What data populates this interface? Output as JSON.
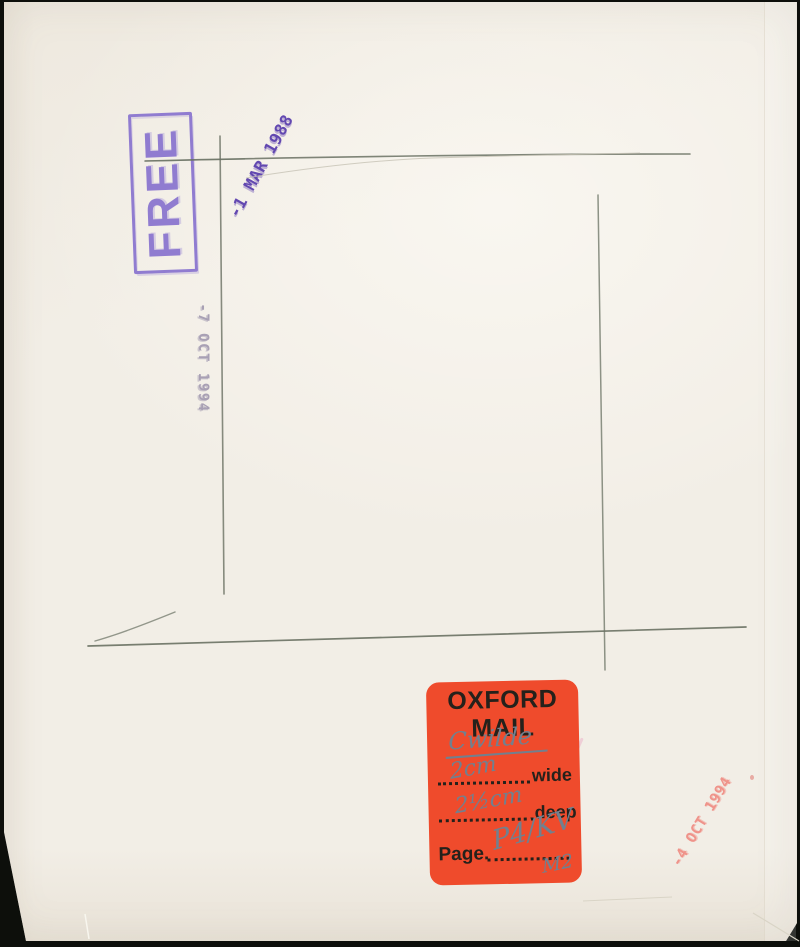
{
  "colors": {
    "backdrop": "#0d0f0b",
    "paper": "#f2eee6",
    "pencil": "#6a7163",
    "stamp_free": "#8873cf",
    "stamp_mar": "#5b3fae",
    "stamp_oct_gray": "#a8a0b4",
    "stamp_oct_red": "#ef938a",
    "sticker_bg": "#ef4b2c",
    "sticker_print": "#25211b",
    "handwriting": "#71808f"
  },
  "stamps": {
    "free": {
      "text": "FREE"
    },
    "mar_1988": {
      "text": "-1 MAR 1988"
    },
    "oct_1994_gray": {
      "text": "-7 OCT 1994"
    },
    "oct_1994_red": {
      "text": "-4 OCT 1994"
    }
  },
  "sticker": {
    "title_line1": "OXFORD",
    "title_line2": "MAIL",
    "handwritten_name": "Cwilde",
    "wide_value": "2cm",
    "wide_label": "wide",
    "deep_value": "2½cm",
    "deep_label": "deep",
    "page_label": "Page.",
    "page_value": "P4/KV",
    "page_value_extra": "M2"
  }
}
